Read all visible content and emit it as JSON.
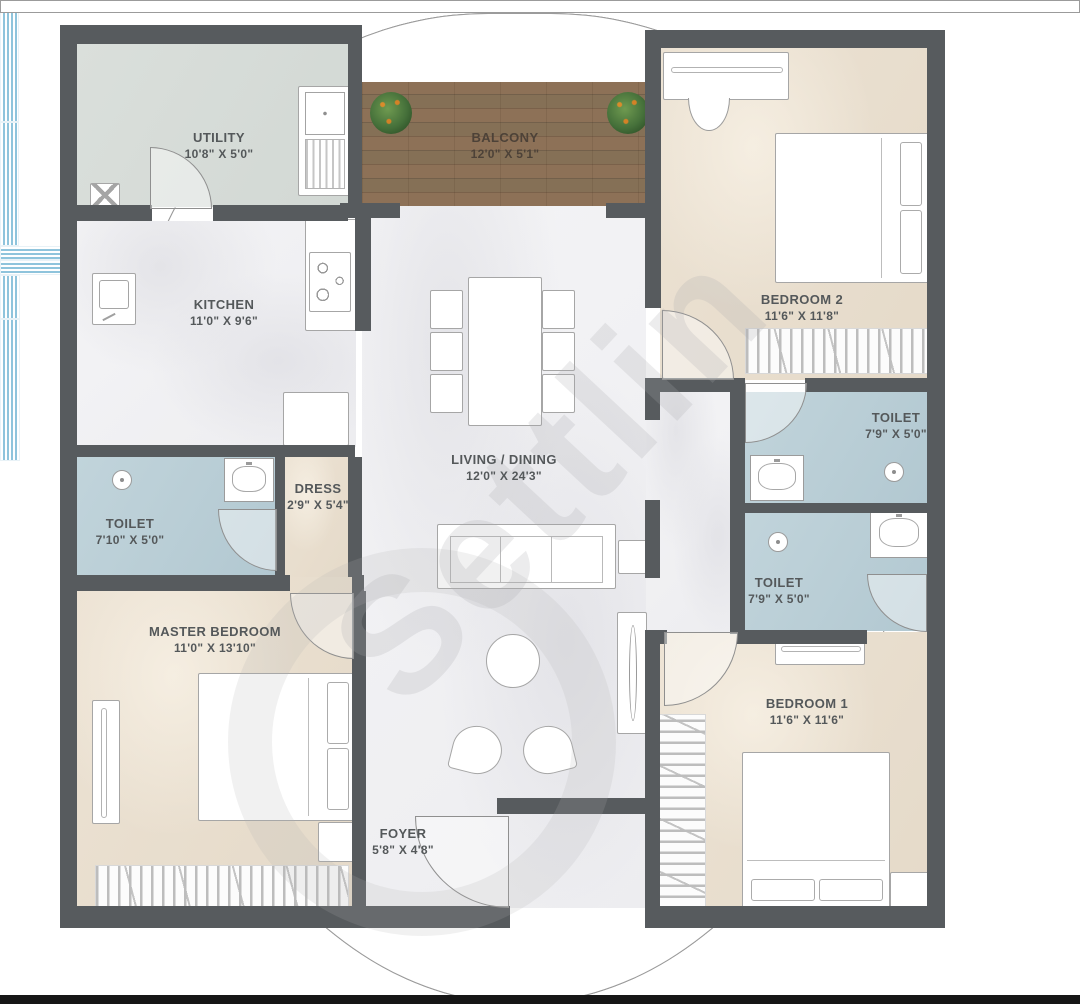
{
  "watermark": "Settlin",
  "rooms": {
    "utility": {
      "name": "UTILITY",
      "dims": "10'8\" X 5'0\""
    },
    "balcony": {
      "name": "BALCONY",
      "dims": "12'0\" X 5'1\""
    },
    "bedroom2": {
      "name": "BEDROOM 2",
      "dims": "11'6\" X 11'8\""
    },
    "kitchen": {
      "name": "KITCHEN",
      "dims": "11'0\" X 9'6\""
    },
    "living_dining": {
      "name": "LIVING / DINING",
      "dims": "12'0\" X 24'3\""
    },
    "toilet_master": {
      "name": "TOILET",
      "dims": "7'10\" X 5'0\""
    },
    "dress": {
      "name": "DRESS",
      "dims": "2'9\" X 5'4\""
    },
    "toilet_common": {
      "name": "TOILET",
      "dims": "7'9\" X 5'0\""
    },
    "toilet_bedroom1": {
      "name": "TOILET",
      "dims": "7'9\" X 5'0\""
    },
    "master_bedroom": {
      "name": "MASTER BEDROOM",
      "dims": "11'0\" X 13'10\""
    },
    "bedroom1": {
      "name": "BEDROOM 1",
      "dims": "11'6\" X 11'6\""
    },
    "foyer": {
      "name": "FOYER",
      "dims": "5'8\" X 4'8\""
    }
  },
  "colors": {
    "wall": "#575b5e",
    "floor_marble": "#f1f1f3",
    "floor_bedroom": "#e9dfd0",
    "floor_toilet": "#bacfd7",
    "floor_utility": "#d7ddd8",
    "floor_balcony_wood": "#85705a",
    "window_glass": "#8fc4dc",
    "label_text": "#54585a"
  }
}
